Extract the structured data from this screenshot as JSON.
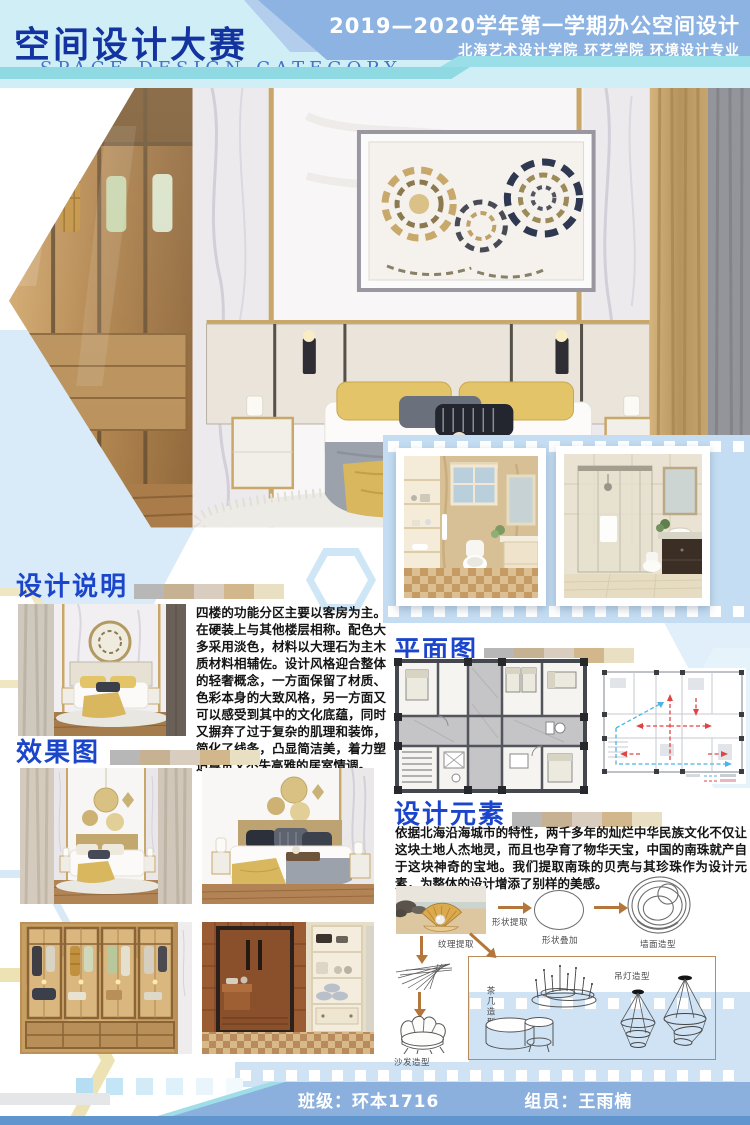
{
  "header": {
    "title": "空间设计大赛",
    "subtitle": "SPACE DESIGN CATEGORY",
    "course": "2019—2020学年第一学期办公空间设计",
    "school": "北海艺术设计学院  环艺学院  环境设计专业"
  },
  "sections": {
    "description": {
      "title": "设计说明",
      "body": "四楼的功能分区主要以客房为主。在硬装上与其他楼层相称。配色大多采用淡色，材料以大理石为主木质材料相辅佐。设计风格迎合整体的轻奢概念，一方面保留了材质、色彩本身的大致风格，另一方面又可以感受到其中的文化底蕴，同时又摒弃了过于复杂的肌理和装饰，简化了线条，凸显简洁美，着力塑造尊贵又不失高雅的居室情调。"
    },
    "renderings": {
      "title": "效果图"
    },
    "floorplan": {
      "title": "平面图"
    },
    "elements": {
      "title": "设计元素",
      "body": "依据北海沿海城市的特性，两千多年的灿烂中华民族文化不仅让这块土地人杰地灵，而且也孕育了物华天宝，中国的南珠就产自于这块神奇的宝地。我们提取南珠的贝壳与其珍珠作为设计元素，为整体的设计增添了别样的美感。",
      "labels": {
        "shape_extract": "形状提取",
        "shape_overlay": "形状叠加",
        "wall_shape": "墙面造型",
        "texture_extract": "纹理提取",
        "sofa_shape": "沙发造型",
        "table_shape": "茶几造型",
        "lamp_shape": "吊灯造型"
      }
    }
  },
  "footer": {
    "class_label": "班级：环本1716",
    "member_label": "组员：王雨楠"
  },
  "palette": [
    "#b7b7b7",
    "#c6b193",
    "#d8cdbf",
    "#d1b78b",
    "#e9e0c3"
  ],
  "colors": {
    "section_title_blue": "#1b46cc",
    "header_title_blue": "#1333a0",
    "banner_blue": "#8cb3e2",
    "teal_accent": "#8fd9e3",
    "film_band_blue": "#c4ddf2",
    "footer_banner_blue": "#8cb0dd",
    "arrow_brown": "#b5763c"
  }
}
